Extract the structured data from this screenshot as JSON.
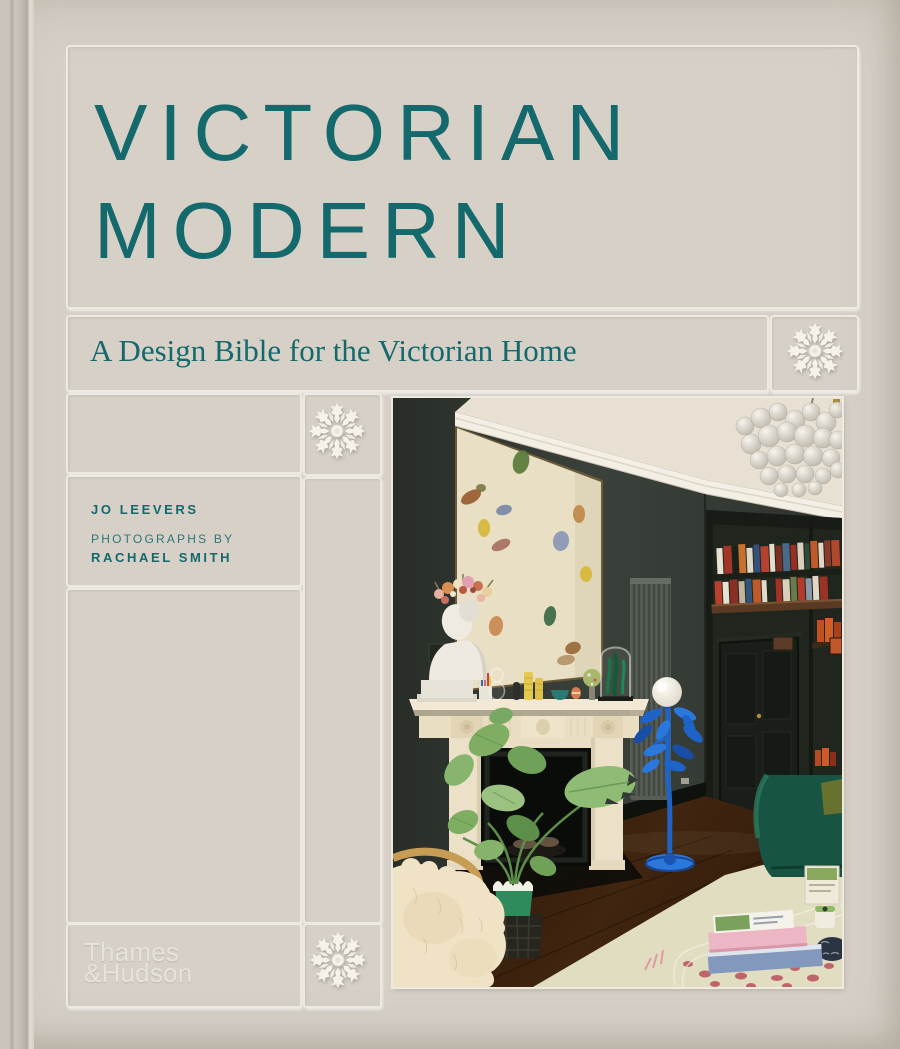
{
  "cover": {
    "title": {
      "line1": "VICTORIAN",
      "line2": "MODERN"
    },
    "subtitle": "A Design Bible for the Victorian Home",
    "author": {
      "name": "JO LEEVERS",
      "credit_prefix": "PHOTOGRAPHS BY",
      "photographer": "RACHAEL SMITH"
    },
    "publisher": {
      "line1": "Thames",
      "line2": "&Hudson"
    },
    "decorations": {
      "rosette_icon": "plaster ceiling-rose flower motif",
      "rosette_count": 3
    },
    "colors": {
      "background": "#d6d0c7",
      "title_teal": "#14696d",
      "panel_line": "#edeae2",
      "publisher_text": "#e9e5dc"
    }
  },
  "photo": {
    "alt": "Victorian living room with dark green walls, abstract painting over a white marble fireplace, classical bust with dried-flower crown, monstera plant, cobalt blue floor lamp with white globe shade, built-in bookshelves with colourful books, glass bubble chandelier, dark panelled door, green velvet sofa, sheepskin armchair and a glass coffee table with stacked books on a pale rug"
  }
}
